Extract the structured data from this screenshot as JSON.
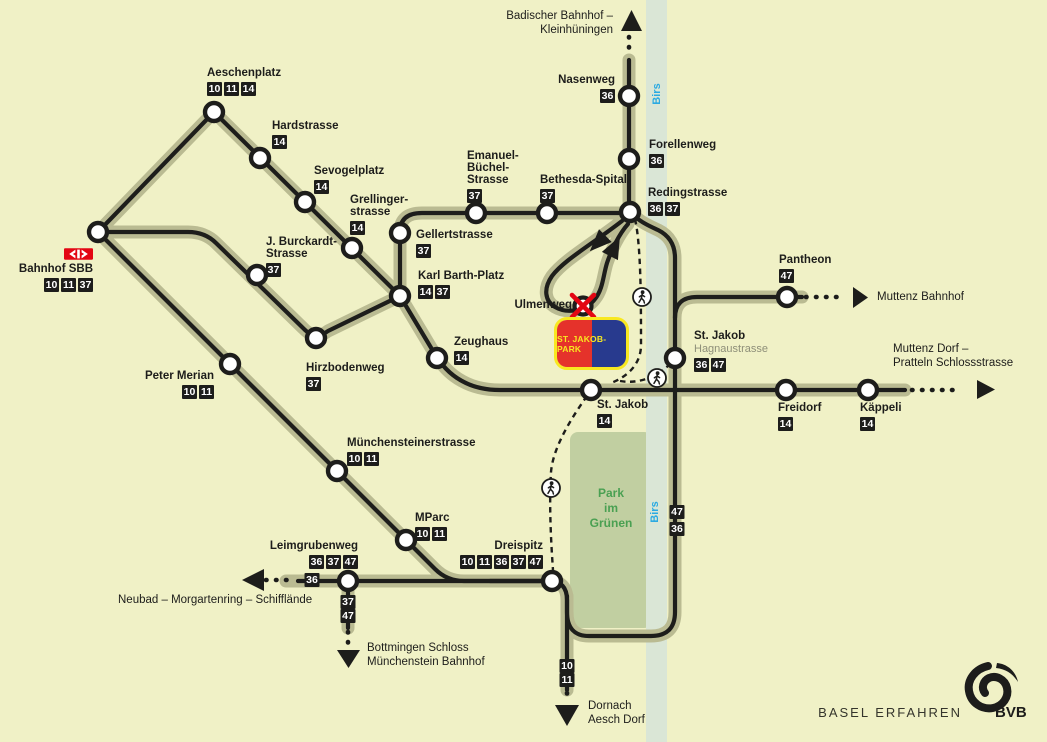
{
  "brand": {
    "text": "BASEL ERFAHREN",
    "abbr": "BVB"
  },
  "river": {
    "name": "Birs"
  },
  "park": {
    "lines": [
      "Park",
      "im",
      "Grünen"
    ]
  },
  "stadium": {
    "label": "ST. JAKOB-PARK"
  },
  "closed_stop": {
    "name": "Ulmenweg"
  },
  "colors": {
    "background": "#f0f1c6",
    "route": "#1d1d1b",
    "route_shadow": "#babb92",
    "river": "#dae6d6",
    "park": "#c1cfa1",
    "park_text": "#4aa052",
    "river_text": "#2baae2",
    "sbb_red": "#e30613",
    "stadium_red": "#e5322b",
    "stadium_blue": "#283a8e",
    "stadium_yellow": "#f8e820"
  },
  "terminals": {
    "badischer": {
      "lines": [
        "Badischer Bahnhof –",
        "Kleinhüningen"
      ]
    },
    "muttenz_bahnhof": {
      "lines": [
        "Muttenz Bahnhof"
      ]
    },
    "muttenz_dorf": {
      "lines": [
        "Muttenz Dorf –",
        "Pratteln Schlossstrasse"
      ]
    },
    "neubad": {
      "lines": [
        "Neubad – Morgartenring – Schifflände"
      ]
    },
    "bottmingen": {
      "lines": [
        "Bottmingen Schloss",
        "Münchenstein Bahnhof"
      ]
    },
    "dornach": {
      "lines": [
        "Dornach",
        "Aesch Dorf"
      ]
    }
  },
  "stations": [
    {
      "id": "aeschenplatz",
      "x": 214,
      "y": 112,
      "label": {
        "x": 207,
        "y": 67,
        "anchor": "left",
        "lines": [
          "Aeschenplatz"
        ],
        "badges": [
          "10",
          "11",
          "14"
        ]
      }
    },
    {
      "id": "hardstrasse",
      "x": 260,
      "y": 158,
      "label": {
        "x": 272,
        "y": 120,
        "anchor": "left",
        "lines": [
          "Hardstrasse"
        ],
        "badges": [
          "14"
        ]
      }
    },
    {
      "id": "sevogelplatz",
      "x": 305,
      "y": 202,
      "label": {
        "x": 314,
        "y": 165,
        "anchor": "left",
        "lines": [
          "Sevogelplatz"
        ],
        "badges": [
          "14"
        ]
      }
    },
    {
      "id": "grellingerstrasse",
      "x": 352,
      "y": 248,
      "label": {
        "x": 350,
        "y": 194,
        "anchor": "left",
        "lines": [
          "Grellinger-",
          "strasse"
        ],
        "badges": [
          "14"
        ]
      }
    },
    {
      "id": "bahnhof-sbb",
      "x": 98,
      "y": 232,
      "logo": "sbb",
      "label": {
        "x": 93,
        "y": 248,
        "anchor": "right",
        "lines": [
          "Bahnhof SBB"
        ],
        "badges": [
          "10",
          "11",
          "37"
        ]
      }
    },
    {
      "id": "j-burckardt-strasse",
      "x": 257,
      "y": 275,
      "label": {
        "x": 266,
        "y": 236,
        "anchor": "left",
        "lines": [
          "J. Burckardt-",
          "Strasse"
        ],
        "badges": [
          "37"
        ]
      }
    },
    {
      "id": "hirzbodenweg",
      "x": 316,
      "y": 338,
      "label": {
        "x": 306,
        "y": 362,
        "anchor": "left",
        "lines": [
          "Hirzbodenweg"
        ],
        "badges": [
          "37"
        ]
      }
    },
    {
      "id": "karl-barth-platz",
      "x": 400,
      "y": 296,
      "label": {
        "x": 418,
        "y": 270,
        "anchor": "left",
        "lines": [
          "Karl Barth-Platz"
        ],
        "badges": [
          "14",
          "37"
        ]
      }
    },
    {
      "id": "gellertstrasse",
      "x": 400,
      "y": 233,
      "label": {
        "x": 416,
        "y": 229,
        "anchor": "left",
        "lines": [
          "Gellertstrasse"
        ],
        "badges": [
          "37"
        ]
      }
    },
    {
      "id": "emanuel-buechel-strasse",
      "x": 476,
      "y": 213,
      "label": {
        "x": 467,
        "y": 150,
        "anchor": "left",
        "lines": [
          "Emanuel-",
          "Büchel-",
          "Strasse"
        ],
        "badges": [
          "37"
        ]
      }
    },
    {
      "id": "bethesda-spital",
      "x": 547,
      "y": 213,
      "label": {
        "x": 540,
        "y": 174,
        "anchor": "left",
        "lines": [
          "Bethesda-Spital"
        ],
        "badges": [
          "37"
        ]
      }
    },
    {
      "id": "redingstrasse",
      "x": 630,
      "y": 212,
      "label": {
        "x": 648,
        "y": 187,
        "anchor": "left",
        "lines": [
          "Redingstrasse"
        ],
        "badges": [
          "36",
          "37"
        ]
      }
    },
    {
      "id": "forellenweg",
      "x": 629,
      "y": 159,
      "label": {
        "x": 649,
        "y": 139,
        "anchor": "left",
        "lines": [
          "Forellenweg"
        ],
        "badges": [
          "36"
        ]
      }
    },
    {
      "id": "nasenweg",
      "x": 629,
      "y": 96,
      "label": {
        "x": 615,
        "y": 74,
        "anchor": "right",
        "lines": [
          "Nasenweg"
        ],
        "badges": [
          "36"
        ]
      }
    },
    {
      "id": "zeughaus",
      "x": 437,
      "y": 358,
      "label": {
        "x": 454,
        "y": 336,
        "anchor": "left",
        "lines": [
          "Zeughaus"
        ],
        "badges": [
          "14"
        ]
      }
    },
    {
      "id": "st-jakob",
      "x": 591,
      "y": 390,
      "label": {
        "x": 597,
        "y": 399,
        "anchor": "left",
        "lines": [
          "St. Jakob"
        ],
        "badges": [
          "14"
        ]
      }
    },
    {
      "id": "st-jakob-hagnaustrasse",
      "x": 675,
      "y": 358,
      "label": {
        "x": 694,
        "y": 330,
        "anchor": "left",
        "lines": [
          "St. Jakob"
        ],
        "sub": "Hagnaustrasse",
        "badges": [
          "36",
          "47"
        ]
      }
    },
    {
      "id": "pantheon",
      "x": 787,
      "y": 297,
      "label": {
        "x": 779,
        "y": 254,
        "anchor": "left",
        "lines": [
          "Pantheon"
        ],
        "badges": [
          "47"
        ]
      }
    },
    {
      "id": "freidorf",
      "x": 786,
      "y": 390,
      "label": {
        "x": 778,
        "y": 402,
        "anchor": "left",
        "lines": [
          "Freidorf"
        ],
        "badges": [
          "14"
        ]
      }
    },
    {
      "id": "kaeppeli",
      "x": 868,
      "y": 390,
      "label": {
        "x": 860,
        "y": 402,
        "anchor": "left",
        "lines": [
          "Käppeli"
        ],
        "badges": [
          "14"
        ]
      }
    },
    {
      "id": "peter-merian",
      "x": 230,
      "y": 364,
      "label": {
        "x": 214,
        "y": 370,
        "anchor": "right",
        "lines": [
          "Peter Merian"
        ],
        "badges": [
          "10",
          "11"
        ]
      }
    },
    {
      "id": "muenchensteinerstrasse",
      "x": 337,
      "y": 471,
      "label": {
        "x": 347,
        "y": 437,
        "anchor": "left",
        "lines": [
          "Münchensteinerstrasse"
        ],
        "badges": [
          "10",
          "11"
        ]
      }
    },
    {
      "id": "mparc",
      "x": 406,
      "y": 540,
      "label": {
        "x": 415,
        "y": 512,
        "anchor": "left",
        "lines": [
          "MParc"
        ],
        "badges": [
          "10",
          "11"
        ]
      }
    },
    {
      "id": "leimgrubenweg",
      "x": 348,
      "y": 581,
      "label": {
        "x": 358,
        "y": 540,
        "anchor": "right",
        "lines": [
          "Leimgrubenweg"
        ],
        "badges": [
          "36",
          "37",
          "47"
        ]
      }
    },
    {
      "id": "dreispitz",
      "x": 552,
      "y": 581,
      "label": {
        "x": 543,
        "y": 540,
        "anchor": "right",
        "lines": [
          "Dreispitz"
        ],
        "badges": [
          "10",
          "11",
          "36",
          "37",
          "47"
        ]
      }
    }
  ],
  "line_badges": [
    {
      "text": "36",
      "x": 312,
      "y": 580
    },
    {
      "text": "37",
      "x": 348,
      "y": 602
    },
    {
      "text": "47",
      "x": 348,
      "y": 616
    },
    {
      "text": "10",
      "x": 567,
      "y": 666
    },
    {
      "text": "11",
      "x": 567,
      "y": 680
    },
    {
      "text": "47",
      "x": 677,
      "y": 512
    },
    {
      "text": "36",
      "x": 677,
      "y": 529
    }
  ],
  "walk_icons": [
    {
      "id": "walk-redingstrasse-stjakob",
      "x": 642,
      "y": 297
    },
    {
      "id": "walk-stjakob-hagnaustrasse",
      "x": 657,
      "y": 378
    },
    {
      "id": "walk-stjakob-dreispitz",
      "x": 551,
      "y": 488
    }
  ]
}
